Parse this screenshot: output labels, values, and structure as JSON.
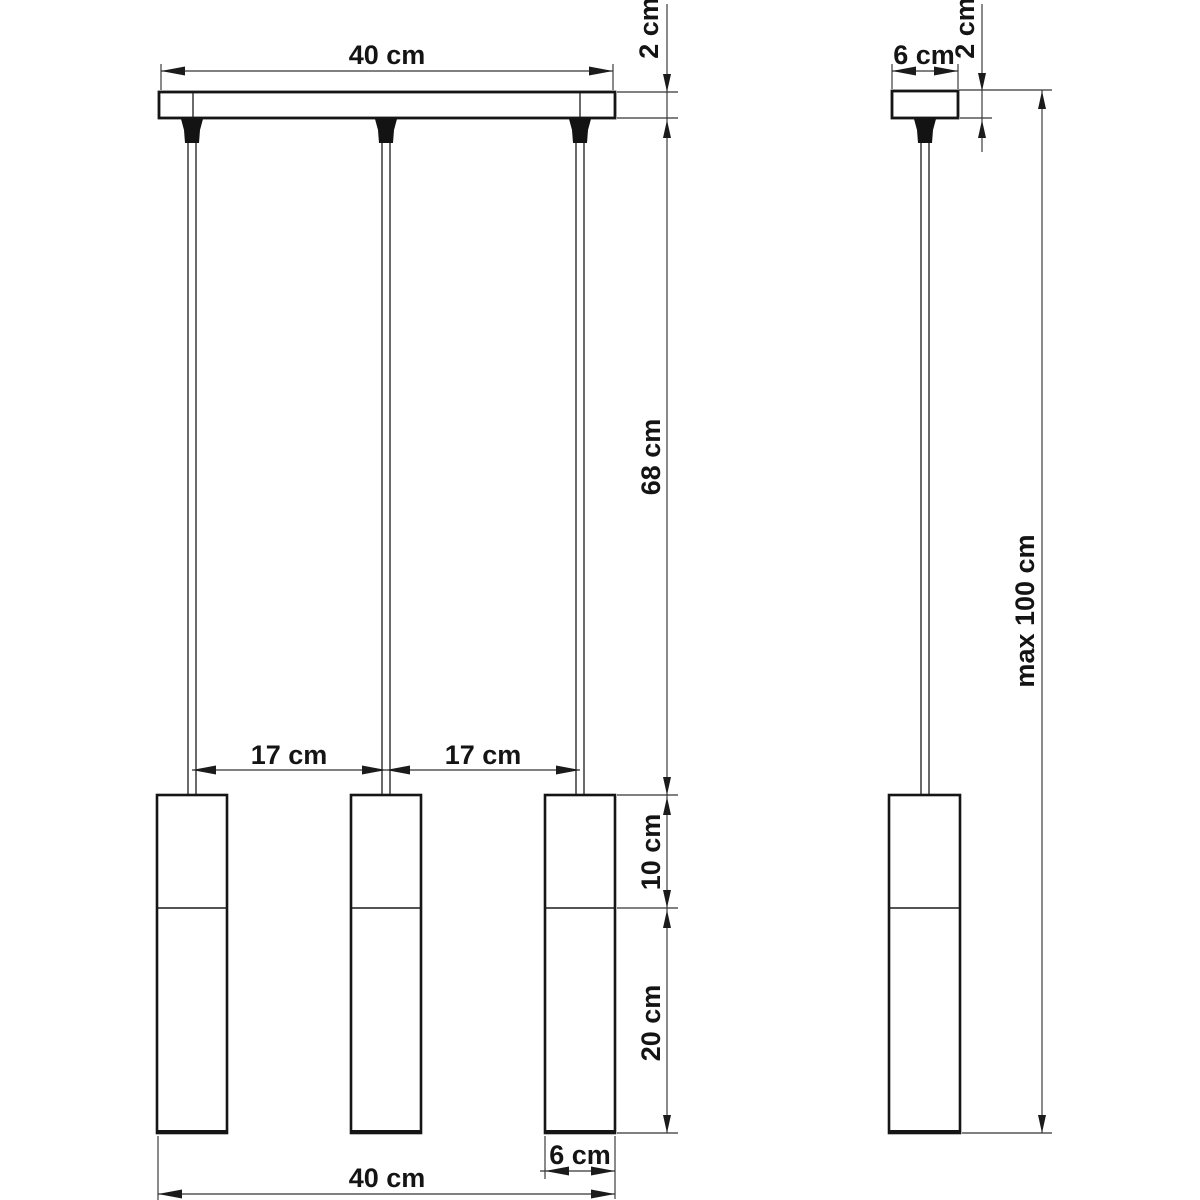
{
  "front": {
    "canopy_width": "40 cm",
    "canopy_height": "2 cm",
    "cable_length": "68 cm",
    "spacing_1": "17 cm",
    "spacing_2": "17 cm",
    "shade_top_section": "10 cm",
    "shade_bottom_section": "20 cm",
    "shade_diameter": "6 cm",
    "overall_width": "40 cm"
  },
  "side": {
    "canopy_depth": "6 cm",
    "canopy_height": "2 cm",
    "max_overall_height": "max 100 cm"
  }
}
